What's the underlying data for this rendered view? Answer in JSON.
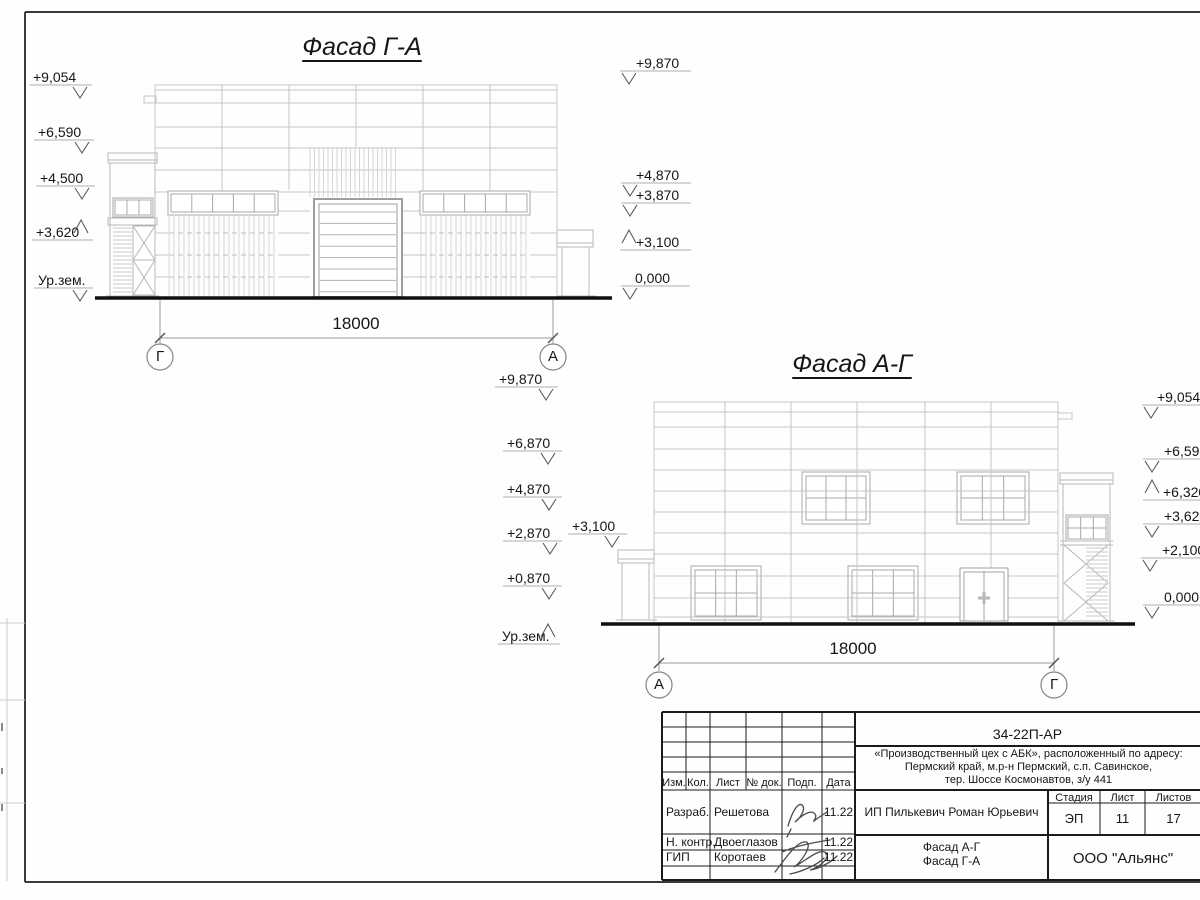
{
  "facade_ga": {
    "title": "Фасад Г-А",
    "dimension": "18000",
    "axis_left": "Г",
    "axis_right": "А",
    "marks_left": [
      {
        "label": "+9,054"
      },
      {
        "label": "+6,590"
      },
      {
        "label": "+4,500"
      },
      {
        "label": "+3,620"
      },
      {
        "label": "Ур.зем."
      }
    ],
    "marks_right": [
      {
        "label": "+9,870"
      },
      {
        "label": "+4,870"
      },
      {
        "label": "+3,870"
      },
      {
        "label": "+3,100"
      },
      {
        "label": "0,000"
      }
    ]
  },
  "facade_ag": {
    "title": "Фасад А-Г",
    "dimension": "18000",
    "axis_left": "А",
    "axis_right": "Г",
    "marks_left": [
      {
        "label": "+9,870"
      },
      {
        "label": "+6,870"
      },
      {
        "label": "+4,870"
      },
      {
        "label": "+2,870"
      },
      {
        "label": "+0,870"
      },
      {
        "label": "Ур.зем."
      }
    ],
    "mark_canopy": {
      "label": "+3,100"
    },
    "marks_right": [
      {
        "label": "+9,054"
      },
      {
        "label": "+6,590"
      },
      {
        "label": "+6,320"
      },
      {
        "label": "+3,620"
      },
      {
        "label": "+2,100"
      },
      {
        "label": "0,000"
      }
    ]
  },
  "title_block": {
    "doc_code": "34-22П-АР",
    "project_line1": "«Производственный цех с АБК», расположенный по адресу:",
    "project_line2": "Пермский край, м.р-н Пермский, с.п. Савинское,",
    "project_line3": "тер. Шоссе Космонавтов, з/у 441",
    "columns": {
      "izm": "Изм.",
      "kol": "Кол.",
      "list": "Лист",
      "doc": "№ док.",
      "podp": "Подп.",
      "data": "Дата"
    },
    "rows": [
      {
        "role": "Разраб.",
        "name": "Решетова",
        "date": "11.22"
      },
      {
        "role": "Н. контр.",
        "name": "Двоеглазов",
        "date": "11.22"
      },
      {
        "role": "ГИП",
        "name": "Коротаев",
        "date": "11.22"
      }
    ],
    "client": "ИП Пилькевич Роман Юрьевич",
    "stage_label": "Стадия",
    "sheet_label": "Лист",
    "sheets_label": "Листов",
    "stage": "ЭП",
    "sheet": "11",
    "sheets": "17",
    "sheet_name_line1": "Фасад А-Г",
    "sheet_name_line2": "Фасад Г-А",
    "company": "ООО \"Альянс\""
  }
}
